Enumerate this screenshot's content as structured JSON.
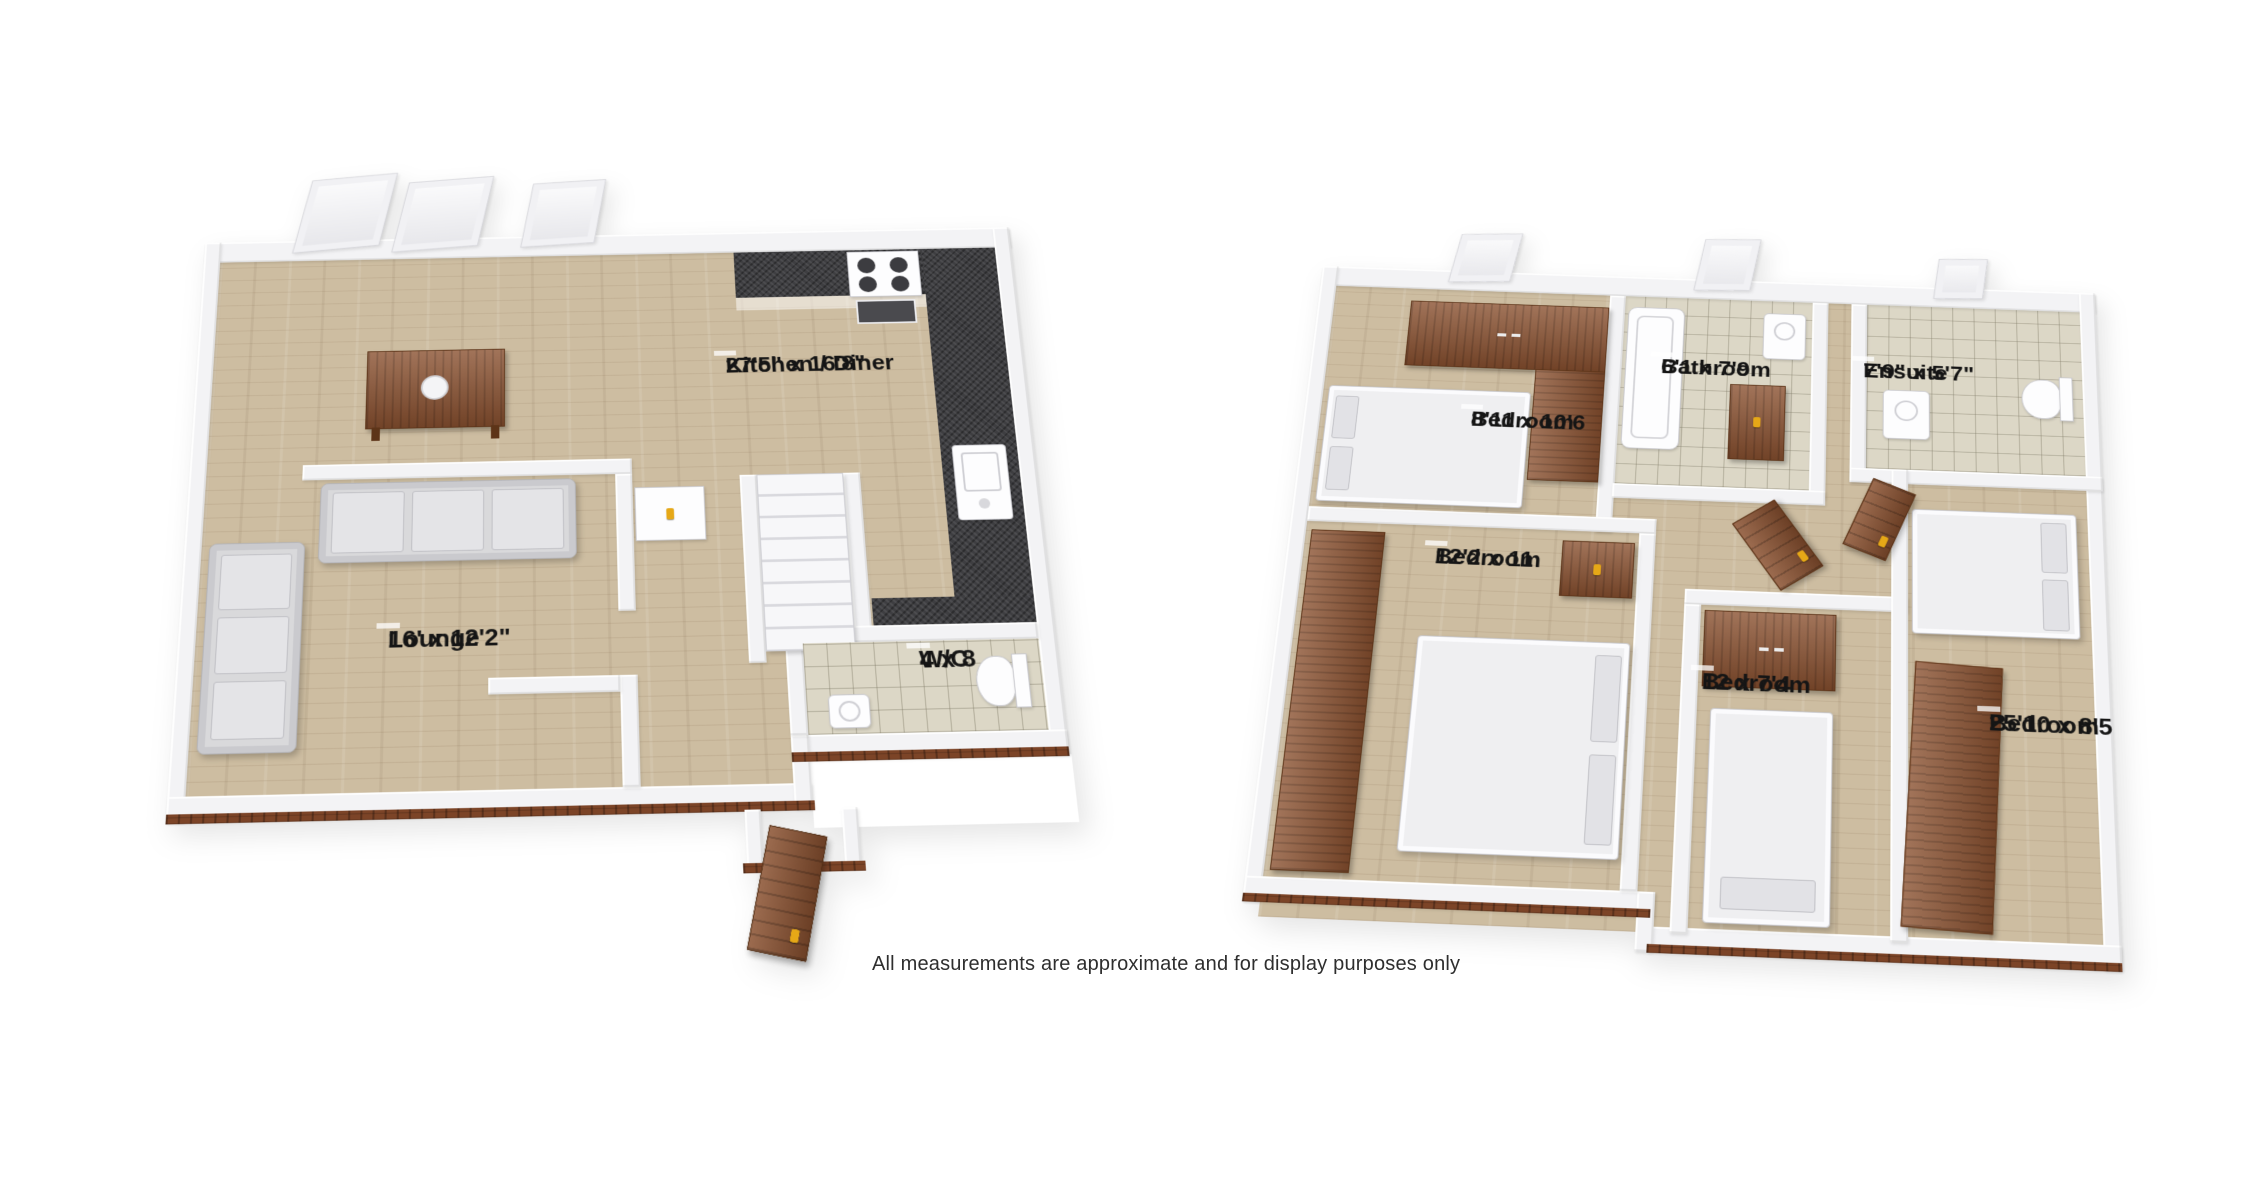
{
  "disclaimer": "All measurements are approximate and for display purposes only",
  "ground_floor": {
    "rooms": {
      "kitchen": {
        "label": "Kitchen / Diner",
        "dims": "27'5\" x 16'8\""
      },
      "lounge": {
        "label": "Lounge",
        "dims": "16' x 12'2\""
      },
      "wc": {
        "label": "W/C",
        "dims": "4 x 8"
      }
    }
  },
  "first_floor": {
    "rooms": {
      "bedroom1": {
        "label": "Bedroom",
        "dims": "8'11 x 10'6"
      },
      "bathroom": {
        "label": "Bathroom",
        "dims": "6'1 x 7'9"
      },
      "ensuite": {
        "label": "Ensuite",
        "dims": "7'9\" x 5'7\""
      },
      "bedroom2": {
        "label": "Bedroom",
        "dims": "12'2 x 11"
      },
      "bedroom3": {
        "label": "Bedroom",
        "dims": "12 x 7'4"
      },
      "bedroom4": {
        "label": "Bedroom",
        "dims": "25'10 x 8'5"
      }
    }
  },
  "colors": {
    "floor_wood": "#cdbda1",
    "floor_tile": "#dcd7c6",
    "granite": "#3e3e41",
    "wall": "#f3f3f5",
    "brick": "#7c4427",
    "furniture_wood": "#8a5130",
    "sofa": "#d9d9db",
    "accent_gold": "#e6a817",
    "label_bg": "rgba(255,255,255,0.75)"
  }
}
